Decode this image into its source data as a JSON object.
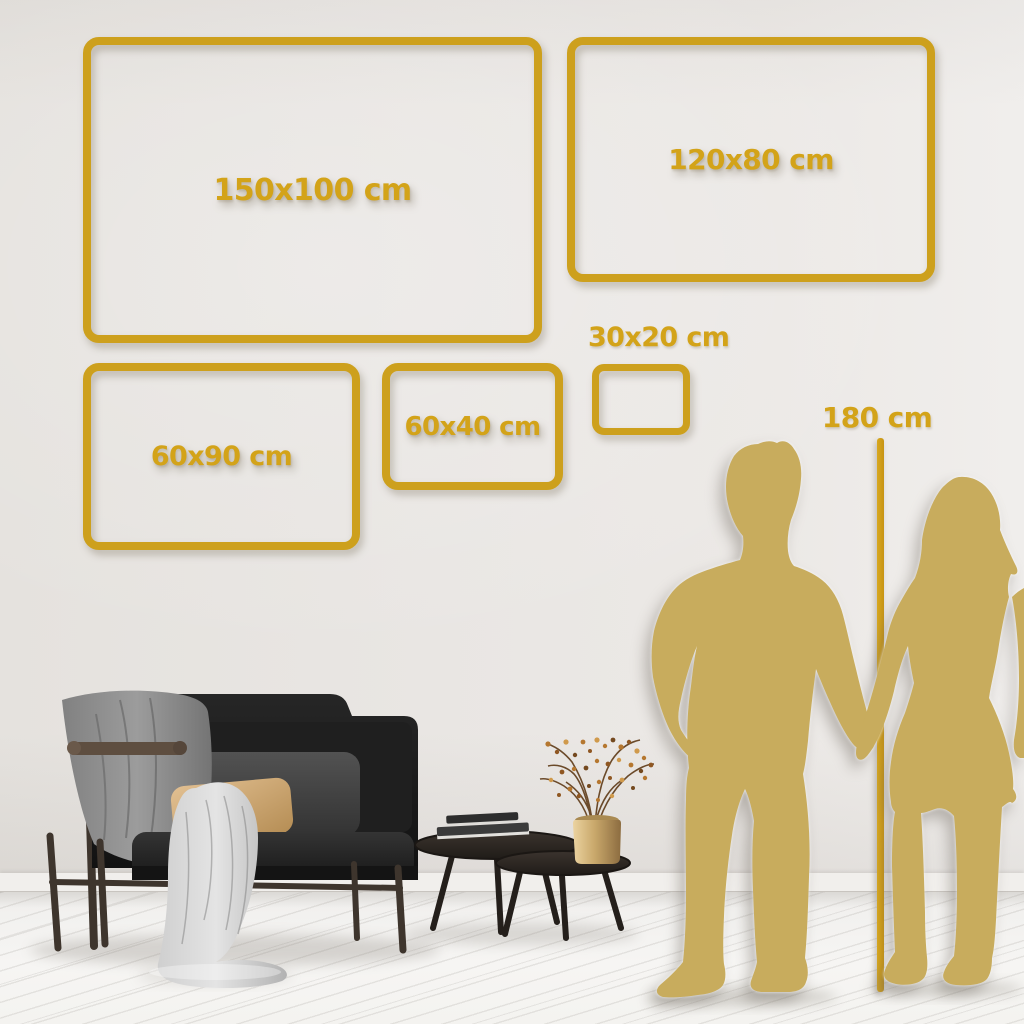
{
  "sizes": [
    {
      "id": "150x100",
      "label": "150x100 cm",
      "width_cm": 150,
      "height_cm": 100
    },
    {
      "id": "120x80",
      "label": "120x80 cm",
      "width_cm": 120,
      "height_cm": 80
    },
    {
      "id": "60x90",
      "label": "60x90 cm",
      "width_cm": 60,
      "height_cm": 90
    },
    {
      "id": "60x40",
      "label": "60x40 cm",
      "width_cm": 60,
      "height_cm": 40
    },
    {
      "id": "30x20",
      "label": "30x20 cm",
      "width_cm": 30,
      "height_cm": 20
    }
  ],
  "height_marker": {
    "label": "180 cm",
    "height_cm": 180
  },
  "colors": {
    "accent_gold": "#CDA01D",
    "label_gold": "#D3A319",
    "silhouette_gold": "#C8AC5D",
    "wall": "#E9E6E3",
    "floor": "#F4F3F1"
  },
  "illustrations": {
    "couple_silhouette": "man and woman holding hands",
    "sofa": "dark loveseat with gray throw blankets and pillows",
    "coffee_tables": "two round nesting coffee tables with books",
    "vase": "brass vase with dried berry branches"
  }
}
